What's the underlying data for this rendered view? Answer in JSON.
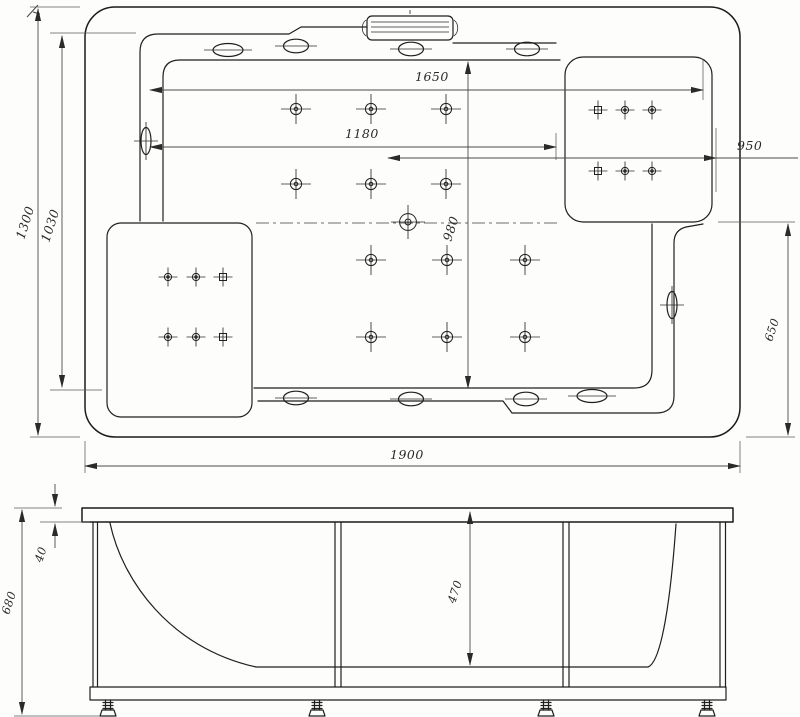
{
  "drawing": {
    "plan_dims": {
      "overall_length": "1900",
      "overall_width": "1300",
      "rim_span": "1030",
      "top_span": "1650",
      "mid_span": "1180",
      "right_offset": "950",
      "basin_height": "980",
      "right_side": "650"
    },
    "side_dims": {
      "overall_height": "680",
      "rim_thickness": "40",
      "inner_depth": "470"
    }
  }
}
